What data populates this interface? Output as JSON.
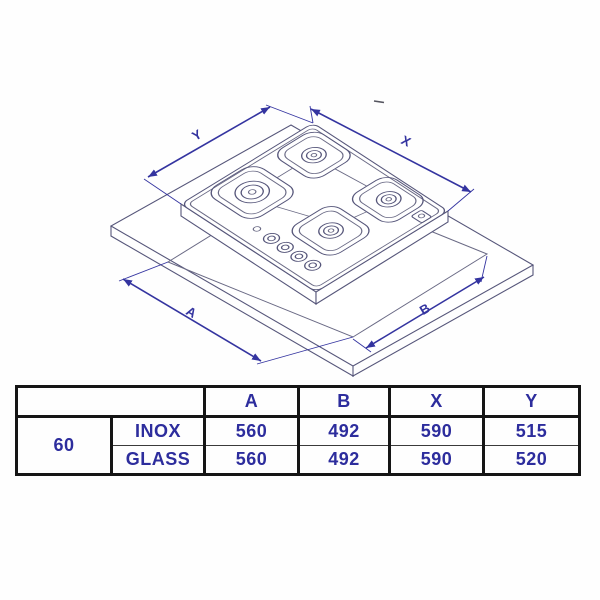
{
  "diagram": {
    "dimension_labels": {
      "top_left": "Y",
      "top_right": "X",
      "bottom_left": "A",
      "bottom_right": "B"
    }
  },
  "table": {
    "size_label": "60",
    "columns": [
      "A",
      "B",
      "X",
      "Y"
    ],
    "rows": [
      {
        "material": "INOX",
        "values": [
          "560",
          "492",
          "590",
          "515"
        ]
      },
      {
        "material": "GLASS",
        "values": [
          "560",
          "492",
          "590",
          "520"
        ]
      }
    ]
  },
  "colors": {
    "dimension_line": "#3434a0",
    "drawing_line": "#56567a",
    "table_text": "#2d2d9d",
    "table_border": "#151515",
    "background": "#ffffff"
  }
}
